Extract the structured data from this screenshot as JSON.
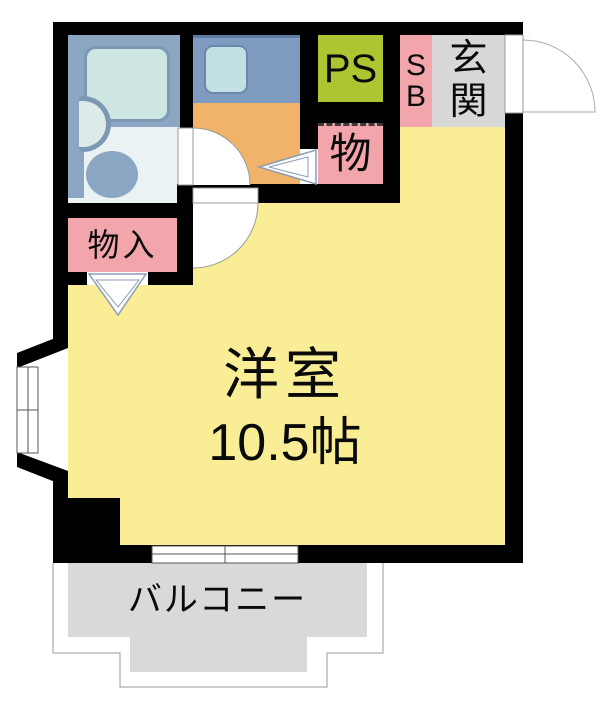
{
  "plan": {
    "rooms": {
      "main": {
        "name": "洋室",
        "size": "10.5帖"
      },
      "balcony": {
        "label": "バルコニー"
      },
      "entrance": {
        "char1": "玄",
        "char2": "関"
      },
      "shoebox": {
        "char1": "S",
        "char2": "B"
      },
      "pipe_space": {
        "label": "PS"
      },
      "storage": {
        "label": "物"
      },
      "closet": {
        "label": "物入"
      }
    },
    "colors": {
      "wall": "#000000",
      "room_yellow": "#f9ee95",
      "kitchen_orange": "#f1b369",
      "accent_pink": "#f2a6ab",
      "ps_green": "#adc531",
      "entrance_gray": "#d8d8d8",
      "balcony_gray": "#d9d9d9",
      "fixture_blue": "#8ba6c2",
      "counter_blue": "#7f9cc0",
      "tub_mint": "#cde6e1",
      "bath_floor": "#eaf2f3"
    }
  }
}
